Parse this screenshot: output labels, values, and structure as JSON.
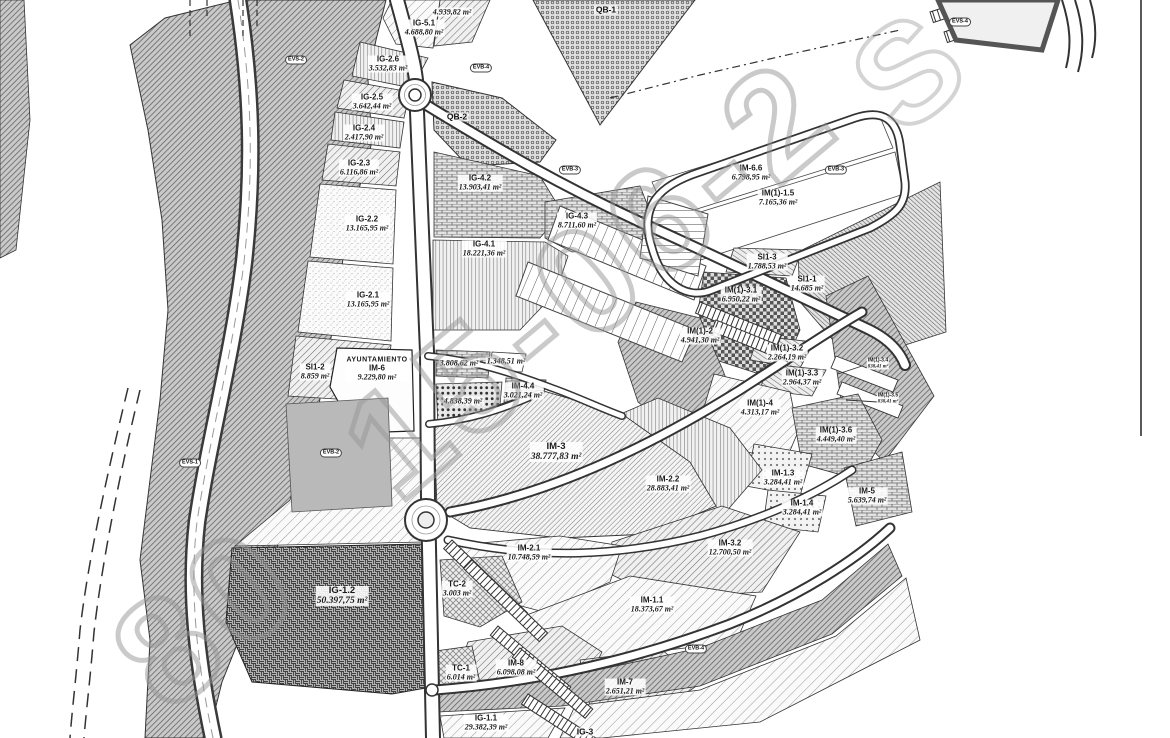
{
  "map": {
    "watermark": {
      "part1": "80",
      "part2": "15-06-2",
      "part3": "S"
    },
    "parcels": [
      {
        "code": "",
        "area": "4.939,82 m²"
      },
      {
        "code": "IG-5.1",
        "area": "4.688,80 m²"
      },
      {
        "code": "IG-2.6",
        "area": "3.532,83 m²"
      },
      {
        "code": "IG-2.5",
        "area": "3.642,44 m²"
      },
      {
        "code": "IG-2.4",
        "area": "2.417,90 m²"
      },
      {
        "code": "IG-2.3",
        "area": "6.116,86 m²"
      },
      {
        "code": "IG-2.2",
        "area": "13.165,95 m²"
      },
      {
        "code": "IG-2.1",
        "area": "13.165,95 m²"
      },
      {
        "code": "SI1-2",
        "area": "8.859 m²"
      },
      {
        "code": "IM-6",
        "area": "9.229,80 m²",
        "title": "AYUNTAMIENTO"
      },
      {
        "code": "IG-4.2",
        "area": "13.903,41 m²"
      },
      {
        "code": "IG-4.3",
        "area": "8.711,60 m²"
      },
      {
        "code": "IG-4.1",
        "area": "18.221,36 m²"
      },
      {
        "code": "IM-6.6",
        "area": "6.798,95 m²"
      },
      {
        "code": "IM(1)-1.5",
        "area": "7.165,36 m²"
      },
      {
        "code": "SI1-3",
        "area": "1.788,53 m²"
      },
      {
        "code": "SI1-1",
        "area": "14.685 m²"
      },
      {
        "code": "IM(1)-3.1",
        "area": "6.950,22 m²"
      },
      {
        "code": "IM(1)-2",
        "area": "4.941,30 m²"
      },
      {
        "code": "IM(1)-3.2",
        "area": "2.264,19 m²"
      },
      {
        "code": "IM(1)-3.3",
        "area": "2.964,37 m²"
      },
      {
        "code": "IM(1)-3.4",
        "area": "838,41 m²"
      },
      {
        "code": "IM(1)-3.5",
        "area": "838,41 m²"
      },
      {
        "code": "IM(1)-4",
        "area": "4.313,17 m²"
      },
      {
        "code": "IM(1)-3.6",
        "area": "4.449,40 m²"
      },
      {
        "code": "IM-5",
        "area": "5.639,74 m²"
      },
      {
        "code": "IM-1.3",
        "area": "3.284,41 m²"
      },
      {
        "code": "IM-1.4",
        "area": "3.284,41 m²"
      },
      {
        "code": "IM-2.2",
        "area": "28.883,41 m²"
      },
      {
        "code": "IM-3",
        "area": "38.777,83 m²"
      },
      {
        "code": "IM-3.2",
        "area": "12.700,50 m²"
      },
      {
        "code": "IM-2.1",
        "area": "10.748,59 m²"
      },
      {
        "code": "TC-2",
        "area": "3.003 m²"
      },
      {
        "code": "IG-1.2",
        "area": "50.397,75 m²"
      },
      {
        "code": "IM-1.1",
        "area": "18.373,67 m²"
      },
      {
        "code": "TC-1",
        "area": "6.014 m²"
      },
      {
        "code": "IM-8",
        "area": "6.098,08 m²"
      },
      {
        "code": "IM-7",
        "area": "2.651,21 m²"
      },
      {
        "code": "IG-1.1",
        "area": "29.382,39 m²"
      },
      {
        "code": "",
        "area": "3.808,62 m²"
      },
      {
        "code": "",
        "area": "1.348,51 m²"
      },
      {
        "code": "IM-4.4",
        "area": "3.021,24 m²"
      },
      {
        "code": "",
        "area": "4.838,39 m²"
      }
    ],
    "zones": [
      {
        "label": "QB-1"
      },
      {
        "label": "QB-2"
      },
      {
        "label": "IG-3"
      }
    ],
    "tags": [
      {
        "label": "EVS-2"
      },
      {
        "label": "EVS-1"
      },
      {
        "label": "EVB-2"
      },
      {
        "label": "EVB-3"
      },
      {
        "label": "EVB-3"
      },
      {
        "label": "EVB-4"
      },
      {
        "label": "EVB-4"
      },
      {
        "label": "EVS-4"
      }
    ]
  }
}
